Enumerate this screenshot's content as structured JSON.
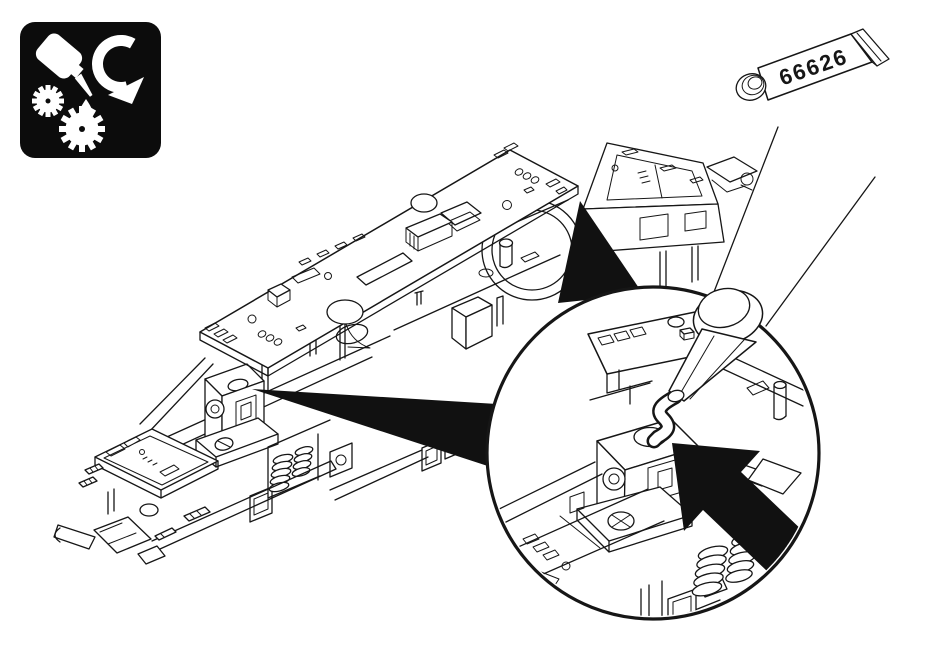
{
  "canvas": {
    "width": 950,
    "height": 657,
    "background": "#ffffff",
    "line_color": "#161616"
  },
  "lubrication_icon": {
    "background": "#0c0c0c",
    "symbols": [
      "oil-bottle",
      "oil-drop",
      "rotation-arrow",
      "small-gear",
      "large-gear"
    ]
  },
  "grease_tube": {
    "label": "66626"
  },
  "drawing": {
    "subject": "locomotive chassis exploded line drawing",
    "detail_view": "magnified circle showing grease application on gearbox tower",
    "pointer": "solid black block arrow at grease point",
    "accent_black": "#111111"
  }
}
